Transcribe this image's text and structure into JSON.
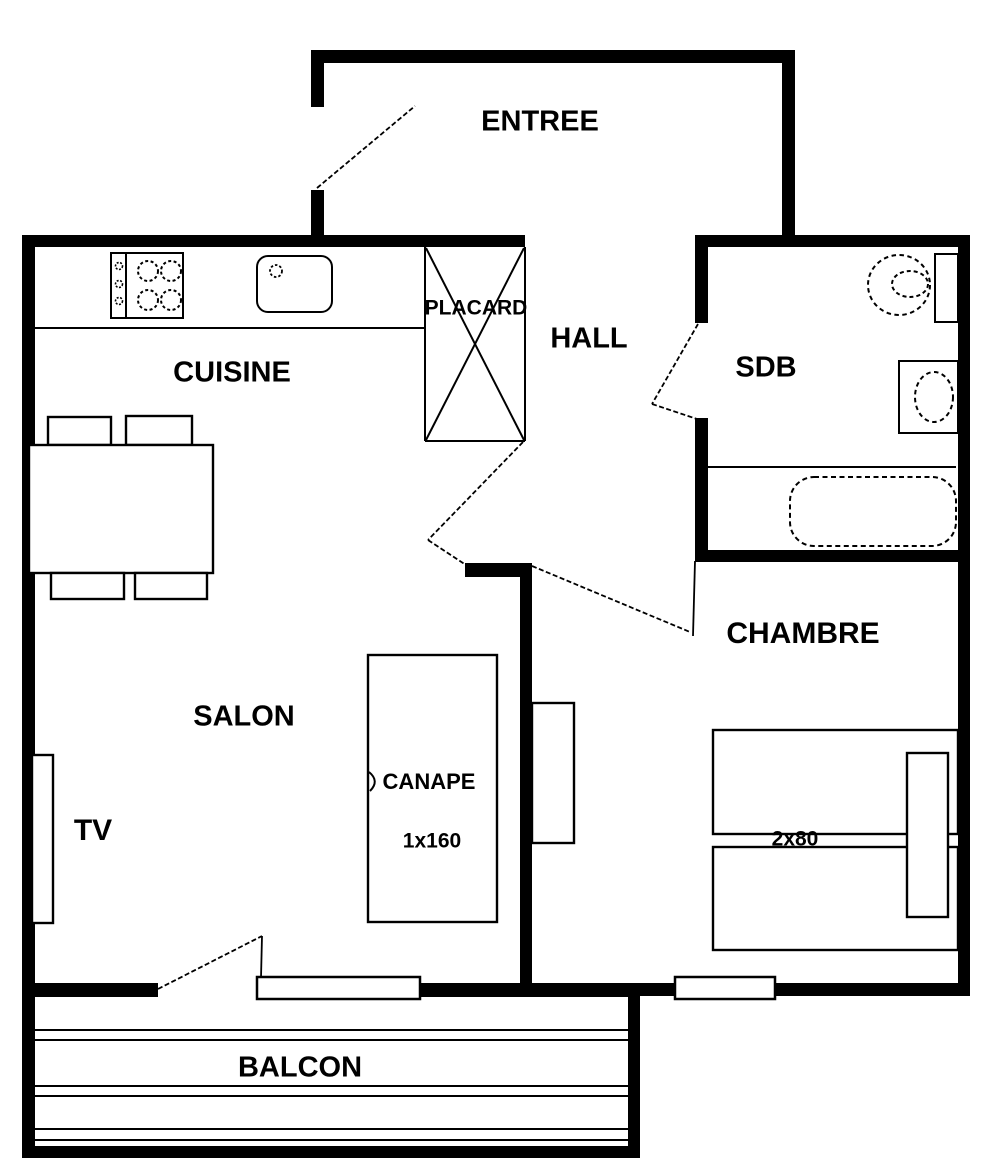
{
  "colors": {
    "wall": "#000000",
    "background": "#ffffff",
    "text": "#000000"
  },
  "rooms": {
    "entree": "ENTREE",
    "cuisine": "CUISINE",
    "hall": "HALL",
    "sdb": "SDB",
    "placard": "PLACARD",
    "salon": "SALON",
    "chambre": "CHAMBRE",
    "balcon": "BALCON"
  },
  "furniture": {
    "canape": "CANAPE",
    "canape_size": "1x160",
    "tv": "TV",
    "beds_size": "2x80"
  }
}
